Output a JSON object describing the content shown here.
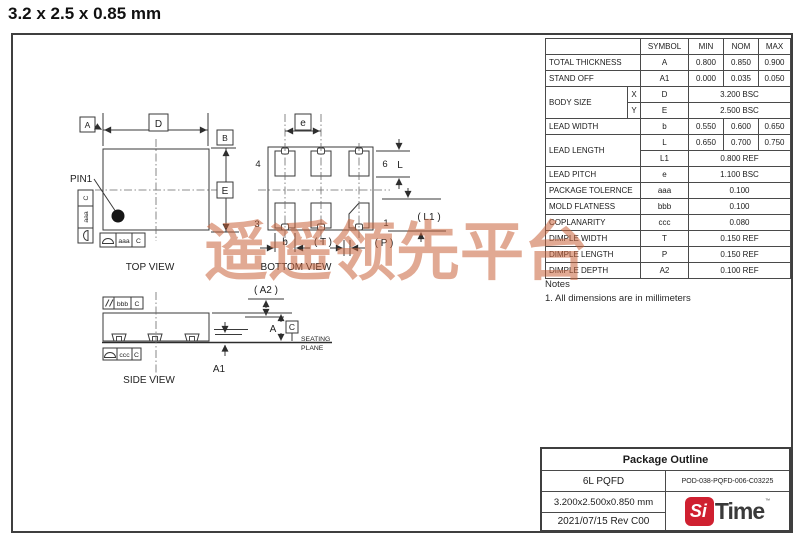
{
  "page": {
    "title": "3.2 x 2.5 x 0.85 mm",
    "watermark_text": "遥遥领先平台",
    "watermark_color": "#c9643c"
  },
  "dim_table": {
    "headers": {
      "symbol": "SYMBOL",
      "min": "MIN",
      "nom": "NOM",
      "max": "MAX"
    },
    "rows": [
      {
        "name": "TOTAL THICKNESS",
        "symbol": "A",
        "min": "0.800",
        "nom": "0.850",
        "max": "0.900"
      },
      {
        "name": "STAND OFF",
        "symbol": "A1",
        "min": "0.000",
        "nom": "0.035",
        "max": "0.050"
      },
      {
        "name": "BODY SIZE",
        "axis": "X",
        "symbol": "D",
        "value": "3.200 BSC"
      },
      {
        "axis": "Y",
        "symbol": "E",
        "value": "2.500 BSC"
      },
      {
        "name": "LEAD WIDTH",
        "symbol": "b",
        "min": "0.550",
        "nom": "0.600",
        "max": "0.650"
      },
      {
        "name": "LEAD LENGTH",
        "symbol": "L",
        "min": "0.650",
        "nom": "0.700",
        "max": "0.750"
      },
      {
        "symbol": "L1",
        "value": "0.800 REF"
      },
      {
        "name": "LEAD PITCH",
        "symbol": "e",
        "value": "1.100 BSC"
      },
      {
        "name": "PACKAGE TOLERNCE",
        "symbol": "aaa",
        "value": "0.100"
      },
      {
        "name": "MOLD FLATNESS",
        "symbol": "bbb",
        "value": "0.100"
      },
      {
        "name": "COPLANARITY",
        "symbol": "ccc",
        "value": "0.080"
      },
      {
        "name": "DIMPLE WIDTH",
        "symbol": "T",
        "value": "0.150 REF"
      },
      {
        "name": "DIMPLE LENGTH",
        "symbol": "P",
        "value": "0.150 REF"
      },
      {
        "name": "DIMPLE DEPTH",
        "symbol": "A2",
        "value": "0.100 REF"
      }
    ]
  },
  "notes": {
    "heading": "Notes",
    "note1": "1. All dimensions are in millimeters"
  },
  "top_view": {
    "caption": "TOP VIEW",
    "pin1_label": "PIN1",
    "dim_d": "D",
    "dim_e": "E",
    "datum_a": "A",
    "datum_b": "B",
    "fcf_left_tol": "aaa",
    "fcf_left_datum": "C",
    "fcf_bottom_tol": "aaa",
    "fcf_bottom_datum": "C"
  },
  "bottom_view": {
    "caption": "BOTTOM VIEW",
    "dim_e": "e",
    "dim_l": "L",
    "dim_l1": "( L1 )",
    "dim_b": "b",
    "dim_t": "( T )",
    "dim_p": "( P )",
    "pin1": "1",
    "pin3": "3",
    "pin4": "4",
    "pin6": "6"
  },
  "side_view": {
    "caption": "SIDE VIEW",
    "dim_a": "A",
    "dim_a1": "A1",
    "dim_a2": "( A2 )",
    "datum_c": "C",
    "fcf_parallel_tol": "bbb",
    "fcf_parallel_datum": "C",
    "fcf_profile_tol": "ccc",
    "fcf_profile_datum": "C",
    "seating_line1": "SEATING",
    "seating_line2": "PLANE"
  },
  "title_block": {
    "heading": "Package Outline",
    "package_name": "6L PQFD",
    "document_number": "POD-038-PQFD-006-C03225",
    "package_size": "3.200x2.500x0.850 mm",
    "date_revision": "2021/07/15  Rev C00",
    "logo_si": "Si",
    "logo_time": "Time",
    "logo_tm": "™",
    "logo_color": "#cf2030"
  }
}
